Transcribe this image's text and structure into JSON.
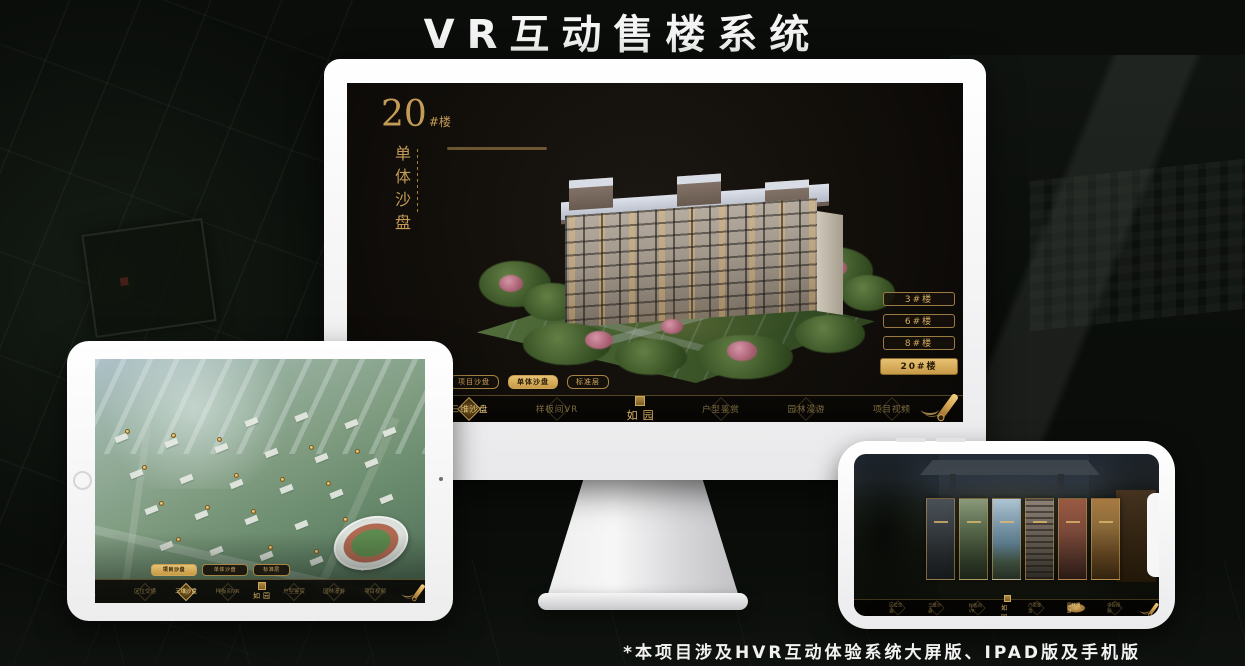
{
  "page": {
    "title": "VR互动售楼系统",
    "footnote": "*本项目涉及HVR互动体验系统大屏版、IPAD版及手机版"
  },
  "colors": {
    "gold": "#c9a35f",
    "gold_bright": "#e0b868",
    "screen_bg": "#12100b",
    "nav_bg": "#070603",
    "active_text": "#241a05"
  },
  "monitor_ui": {
    "heading": {
      "number": "20",
      "suffix": "#楼",
      "subtitle": "单体沙盘"
    },
    "building_buttons": {
      "items": [
        "3#楼",
        "6#楼",
        "8#楼",
        "20#楼"
      ],
      "active_index": 3
    },
    "sub_tabs": {
      "items": [
        "项目沙盘",
        "单体沙盘",
        "标准层"
      ],
      "active_index": 1
    },
    "nav": {
      "logo": "如园",
      "items_left": [
        "区位交通",
        "三维沙盘",
        "样板间VR"
      ],
      "items_right": [
        "户型鉴赏",
        "园林漫游",
        "项目视频"
      ],
      "active_item": "三维沙盘"
    }
  },
  "ipad_ui": {
    "sub_tabs": {
      "items": [
        "项目沙盘",
        "单体沙盘",
        "标准层"
      ],
      "active_index": 0
    },
    "nav": {
      "logo": "如园",
      "items_left": [
        "区位交通",
        "三维沙盘",
        "样板间VR"
      ],
      "items_right": [
        "户型鉴赏",
        "园林漫游",
        "项目视频"
      ],
      "active_item": "三维沙盘"
    }
  },
  "phone_ui": {
    "nav": {
      "logo": "如园",
      "items_left": [
        "区位交通",
        "三维沙盘",
        "样板间VR"
      ],
      "items_right": [
        "户型鉴赏",
        "园林漫游",
        "项目视频"
      ],
      "active_item": "园林漫游"
    },
    "cards": [
      "entrance",
      "interior-green",
      "landscape",
      "building",
      "autumn",
      "interior-warm"
    ]
  }
}
